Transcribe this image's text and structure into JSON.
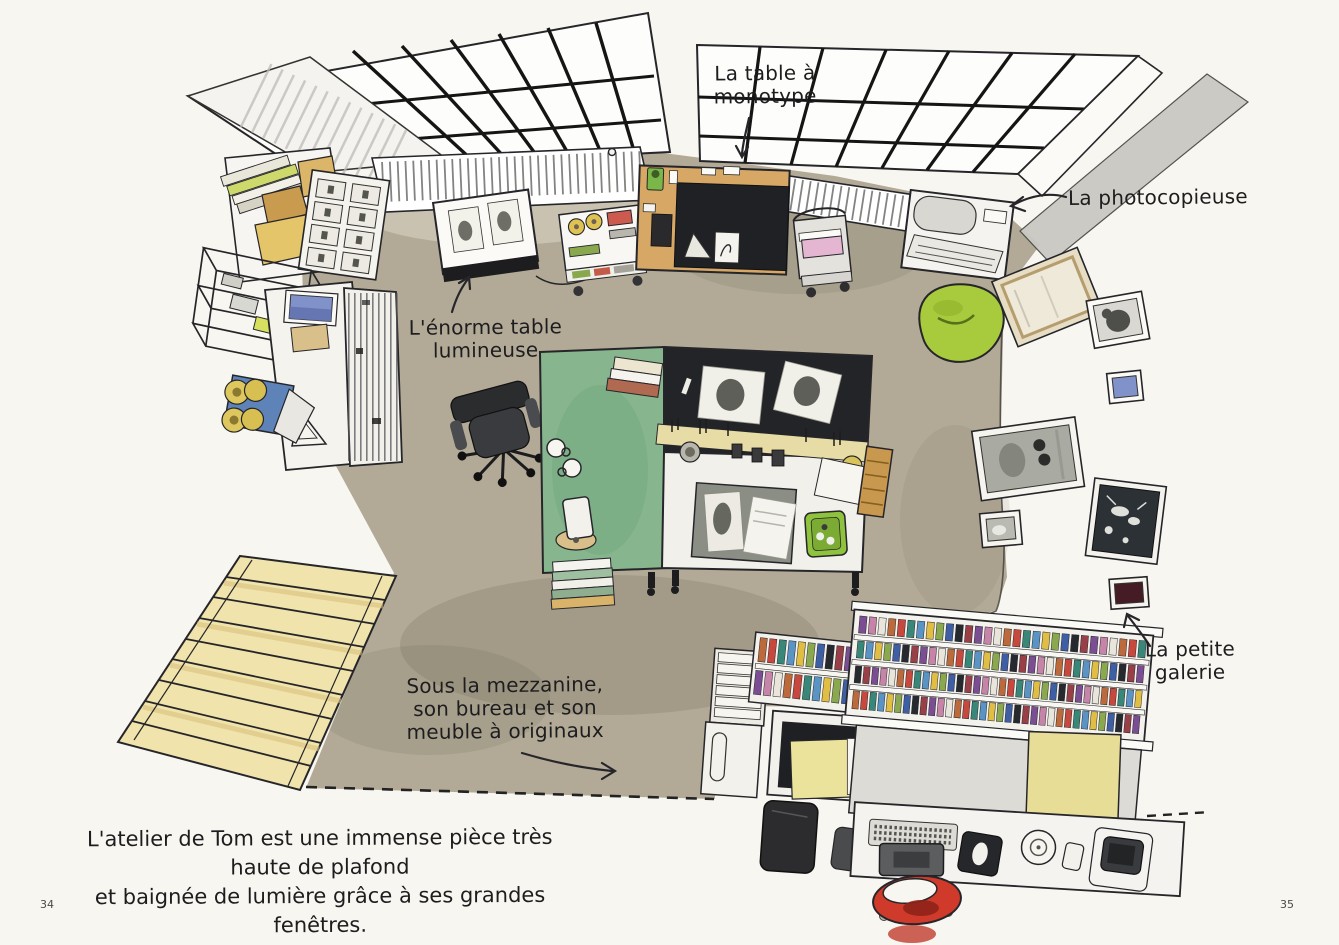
{
  "page": {
    "left_page_number": "34",
    "right_page_number": "35",
    "caption": {
      "line1": "L'atelier de Tom est une immense pièce très haute de plafond",
      "line2": "et baignée de lumière grâce à ses grandes fenêtres."
    }
  },
  "annotations": {
    "monotype_table": {
      "line1": "La table à",
      "line2": "monotype"
    },
    "photocopier": {
      "label": "La photocopieuse"
    },
    "light_table": {
      "line1": "L'énorme table",
      "line2": "lumineuse"
    },
    "small_gallery": {
      "line1": "La petite",
      "line2": "galerie"
    },
    "mezzanine": {
      "line1": "Sous la mezzanine,",
      "line2": "son bureau et son",
      "line3": "meuble à originaux"
    }
  },
  "colors": {
    "paper": "#f8f6f0",
    "ink": "#26262a",
    "floor": "#b2aa97",
    "wood": "#d7a766",
    "green_table": "#86b58e",
    "beanbag_green": "#a8cb3d",
    "stairs_yellow": "#f0e3ab",
    "stool_red": "#cf3a2a",
    "paper_pink": "#e4b6d2",
    "frame_blue": "#8191c9",
    "box_blue": "#5d83b8",
    "folder_yellow": "#ebe29c",
    "tray_green": "#8fc33e",
    "maroon_frame": "#451c25",
    "binder_palette": [
      "#c7493d",
      "#3f5fa5",
      "#e9e5da",
      "#e0bd43",
      "#7b4d92",
      "#398778",
      "#26292e",
      "#bc6a3c",
      "#8aa84e",
      "#c684a8",
      "#5a94c4",
      "#993f48"
    ]
  }
}
